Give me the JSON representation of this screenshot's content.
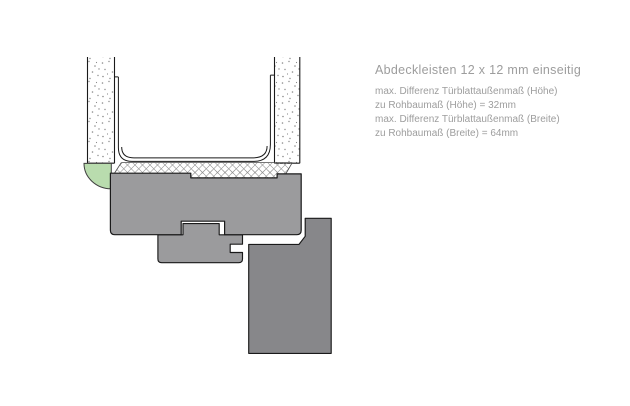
{
  "annotation": {
    "title": "Abdeckleisten 12 x 12 mm einseitig",
    "lines": [
      "max. Differenz Türblattaußenmaß (Höhe)",
      "zu Rohbaumaß (Höhe) = 32mm",
      "max. Differenz Türblattaußenmaß (Breite)",
      "zu Rohbaumaß (Breite) = 64mm"
    ]
  },
  "colors": {
    "frame_gray": "#9b9b9d",
    "door_leaf_gray": "#87878a",
    "seal_green": "#b9dcae",
    "outline": "#1a1a1a",
    "hatch_line": "#8f8f8f",
    "stipple_dot": "#8a8a8a",
    "text_gray": "#9d9d9d"
  }
}
